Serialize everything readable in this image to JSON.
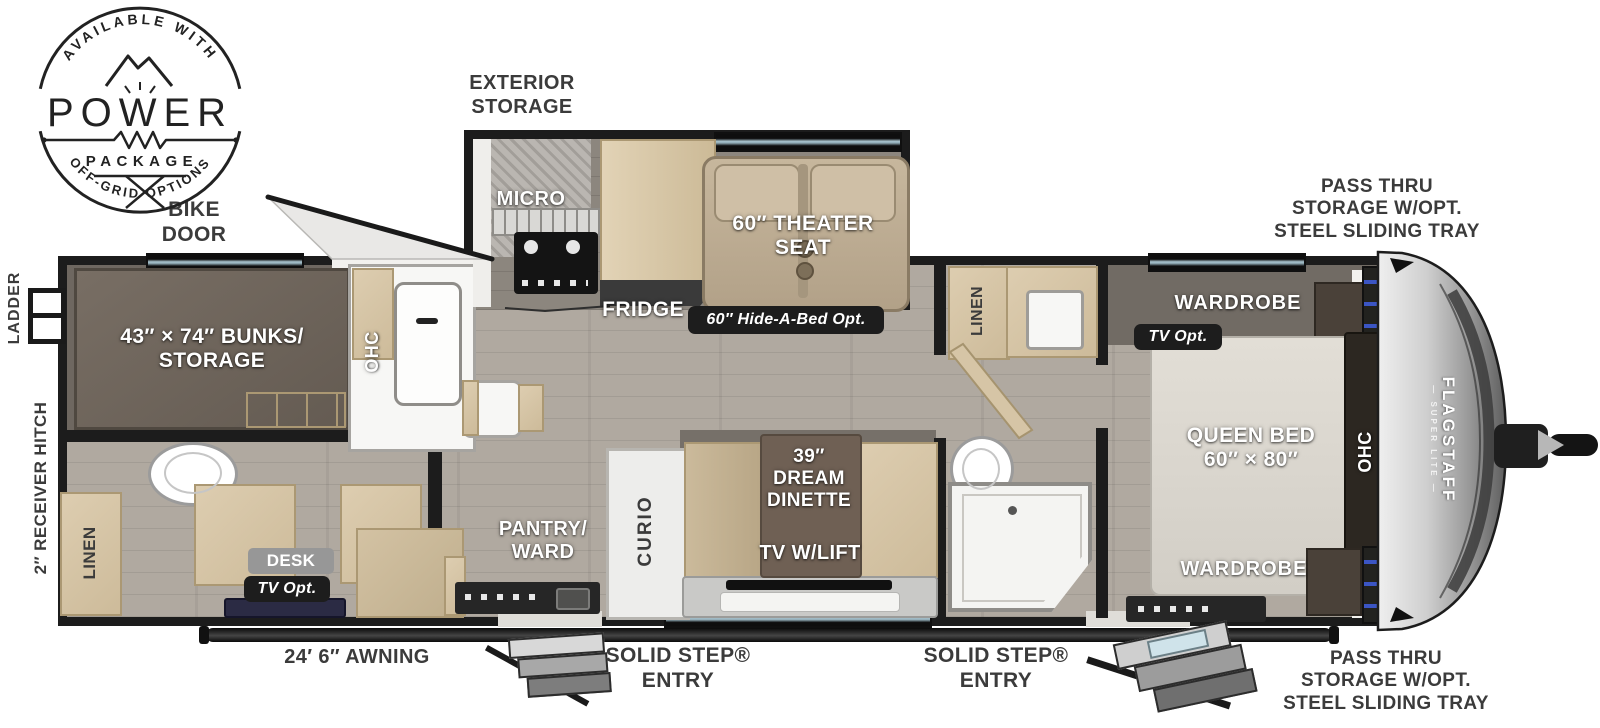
{
  "badge": {
    "arc_top": "AVAILABLE WITH",
    "power": "POWER",
    "package": "PACKAGE",
    "arc_bottom": "OFF-GRID OPTIONS"
  },
  "outside": {
    "bike_door": "BIKE\nDOOR",
    "exterior_storage": "EXTERIOR\nSTORAGE",
    "ladder": "LADDER",
    "receiver_hitch": "2″ RECEIVER HITCH",
    "awning": "24′ 6″ AWNING",
    "entry_left": "SOLID STEP®\nENTRY",
    "entry_right": "SOLID STEP®\nENTRY",
    "pass_thru_top": "PASS THRU\nSTORAGE W/OPT.\nSTEEL SLIDING TRAY",
    "pass_thru_bottom": "PASS THRU\nSTORAGE W/OPT.\nSTEEL SLIDING TRAY"
  },
  "interior": {
    "bunks": "43″ × 74″ BUNKS/\nSTORAGE",
    "ohc_bunk": "OHC",
    "micro": "MICRO",
    "fridge": "FRIDGE",
    "theater": "60″ THEATER\nSEAT",
    "hide_a_bed": "60″ Hide-A-Bed Opt.",
    "linen_rear": "LINEN",
    "desk": "DESK",
    "desk_tv": "TV Opt.",
    "pantry": "PANTRY/\nWARD",
    "curio": "CURIO",
    "dinette": "39″\nDREAM\nDINETTE",
    "tv_lift": "TV W/LIFT",
    "linen_bath": "LINEN",
    "wardrobe_top": "WARDROBE",
    "bed_tv": "TV Opt.",
    "queen_bed": "QUEEN BED\n60″ × 80″",
    "ohc_bed": "OHC",
    "wardrobe_bottom": "WARDROBE"
  },
  "brand": {
    "name": "FLAGSTAFF",
    "model": "— SUPER LITE —"
  },
  "colors": {
    "wall": "#1c1c1c",
    "floor": "#b0a9a0",
    "slide_floor": "#8c867e",
    "wood": "#d6c5a6",
    "shelf_accent_blue": "#3b55c4",
    "label_dark": "#3b3b3b"
  }
}
